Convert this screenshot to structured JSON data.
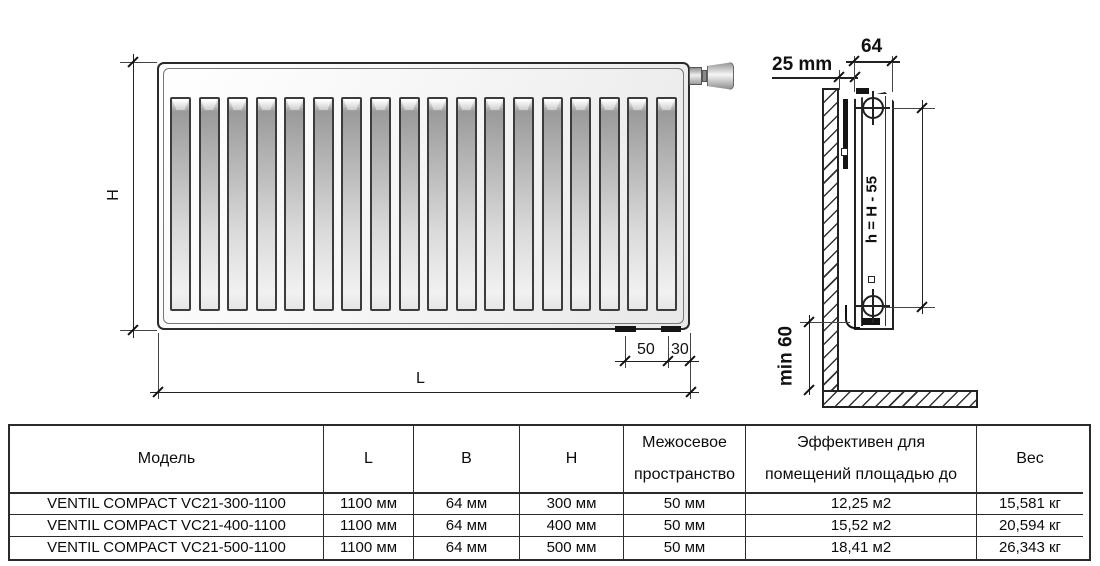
{
  "drawing": {
    "front_view": {
      "height_dim_label": "H",
      "length_dim_label": "L",
      "bottom_dim_50": "50",
      "bottom_dim_30": "30"
    },
    "side_view": {
      "wall_offset_dim": "25 mm",
      "depth_dim": "64",
      "axle_height_formula": "h = H - 55",
      "floor_clearance_dim": "min 60"
    }
  },
  "table": {
    "headers": {
      "model": "Модель",
      "l": "L",
      "b": "B",
      "h": "H",
      "spacing": "Межосевое пространство",
      "area": "Эффективен для помещений площадью до",
      "weight": "Вес"
    },
    "rows": [
      {
        "model": "VENTIL COMPACT VC21-300-1100",
        "l": "1100 мм",
        "b": "64 мм",
        "h": "300 мм",
        "spacing": "50 мм",
        "area": "12,25 м2",
        "weight": "15,581 кг"
      },
      {
        "model": "VENTIL COMPACT VC21-400-1100",
        "l": "1100 мм",
        "b": "64 мм",
        "h": "400 мм",
        "spacing": "50 мм",
        "area": "15,52 м2",
        "weight": "20,594 кг"
      },
      {
        "model": "VENTIL COMPACT VC21-500-1100",
        "l": "1100 мм",
        "b": "64 мм",
        "h": "500 мм",
        "spacing": "50 мм",
        "area": "18,41 м2",
        "weight": "26,343 кг"
      }
    ]
  }
}
